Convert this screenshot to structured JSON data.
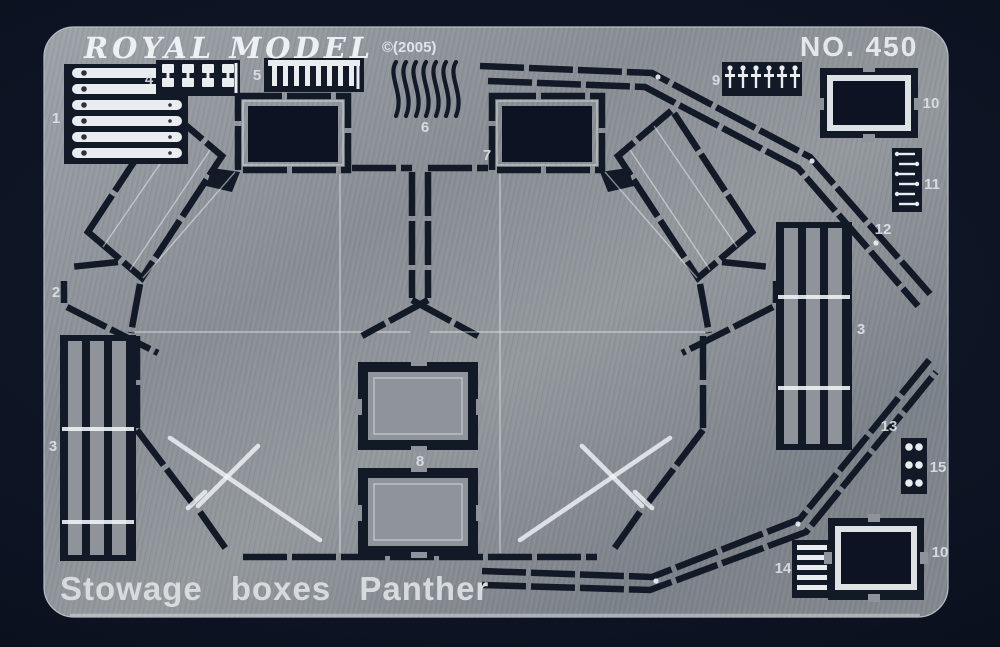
{
  "sheet": {
    "brand": "ROYAL MODEL",
    "copyright": "©(2005)",
    "number": "NO. 450",
    "title": "Stowage boxes Panther"
  },
  "colors": {
    "background": "#0d1322",
    "metal": "#8b9197",
    "etch_dark": "#121a28",
    "etched_window": "#0d1322",
    "bright_part": "#e9edf0",
    "label_text": "#dfe5ea"
  },
  "part_labels": [
    {
      "num": "1"
    },
    {
      "num": "2"
    },
    {
      "num": "3"
    },
    {
      "num": "4"
    },
    {
      "num": "5"
    },
    {
      "num": "6"
    },
    {
      "num": "7"
    },
    {
      "num": "8"
    },
    {
      "num": "9"
    },
    {
      "num": "10"
    },
    {
      "num": "11"
    },
    {
      "num": "12"
    },
    {
      "num": "3"
    },
    {
      "num": "13"
    },
    {
      "num": "15"
    },
    {
      "num": "14"
    },
    {
      "num": "10"
    }
  ]
}
